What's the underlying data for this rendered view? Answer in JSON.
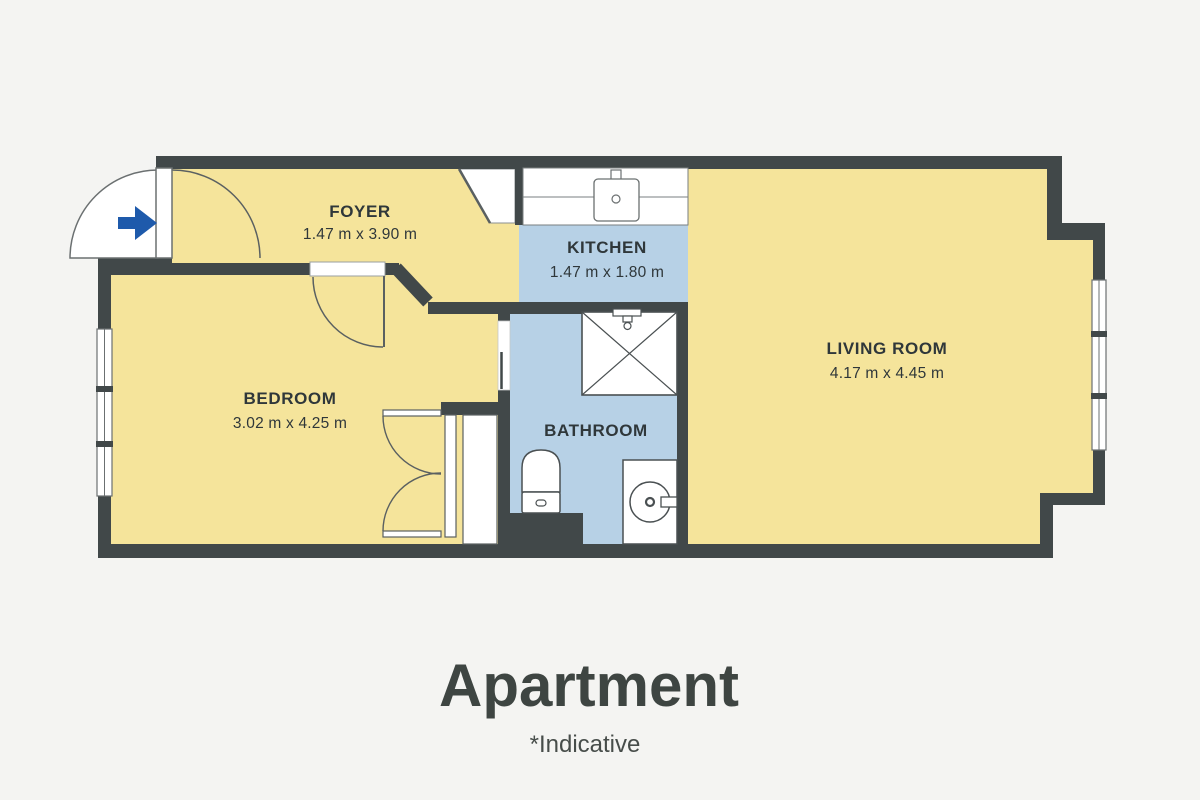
{
  "plan": {
    "colors": {
      "background": "#F4F4F2",
      "wall": "#414849",
      "room_yellow": "#F5E49B",
      "room_blue": "#B7D1E6",
      "fixture_white": "#FFFFFF",
      "fixture_outline": "#5A6061",
      "text": "#2F373A",
      "entry_arrow_blue": "#1E5AAB"
    },
    "rooms": [
      {
        "id": "foyer",
        "label": "FOYER",
        "dims": "1.47 m x 3.90 m"
      },
      {
        "id": "kitchen",
        "label": "KITCHEN",
        "dims": "1.47 m x 1.80 m"
      },
      {
        "id": "living-room",
        "label": "LIVING ROOM",
        "dims": "4.17 m x 4.45 m"
      },
      {
        "id": "bedroom",
        "label": "BEDROOM",
        "dims": "3.02 m x 4.25 m"
      },
      {
        "id": "bathroom",
        "label": "BATHROOM"
      }
    ]
  },
  "footer": {
    "title": "Apartment",
    "note": "*Indicative"
  }
}
